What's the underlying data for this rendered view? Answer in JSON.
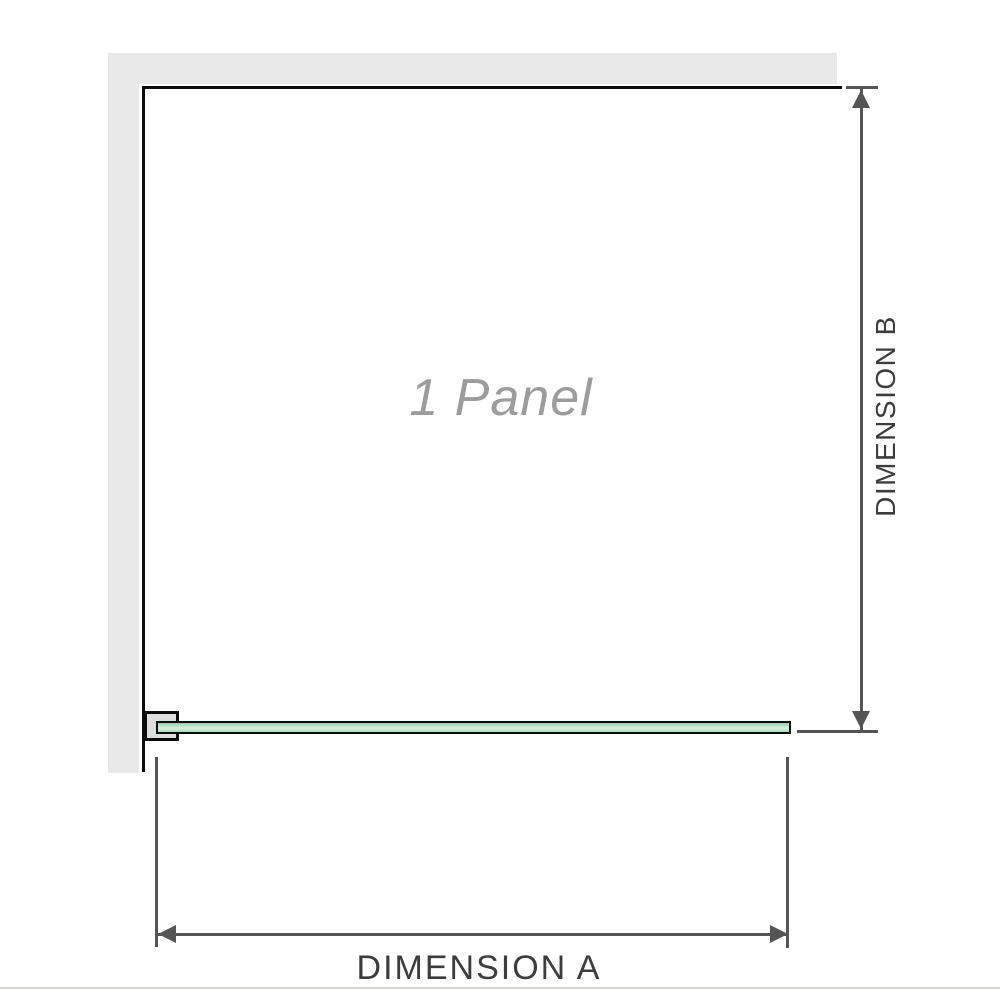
{
  "diagram": {
    "title": "shower-screen-plan-view",
    "panel_label": "1 Panel",
    "dimension_a_label": "DIMENSION A",
    "dimension_b_label": "DIMENSION B"
  },
  "colors": {
    "background": "#ffffff",
    "wall_fill": "#e9e9e9",
    "wall_edge": "#0c0c0c",
    "glass_border": "#0b0b0b",
    "glass_fill_top": "#93cead",
    "glass_fill_mid": "#d9f0e0",
    "glass_fill_bottom": "#addcc0",
    "bracket_fill": "#dedede",
    "dimension_line": "#555555",
    "dimension_text": "#3d3d3d",
    "panel_label_text": "#9c9c9c",
    "footer_rule": "#d9d8d3"
  },
  "icons": {
    "dimension_b_top": "arrow-up-icon",
    "dimension_b_bottom": "arrow-down-icon",
    "dimension_a_left": "arrow-left-icon",
    "dimension_a_right": "arrow-right-icon"
  }
}
